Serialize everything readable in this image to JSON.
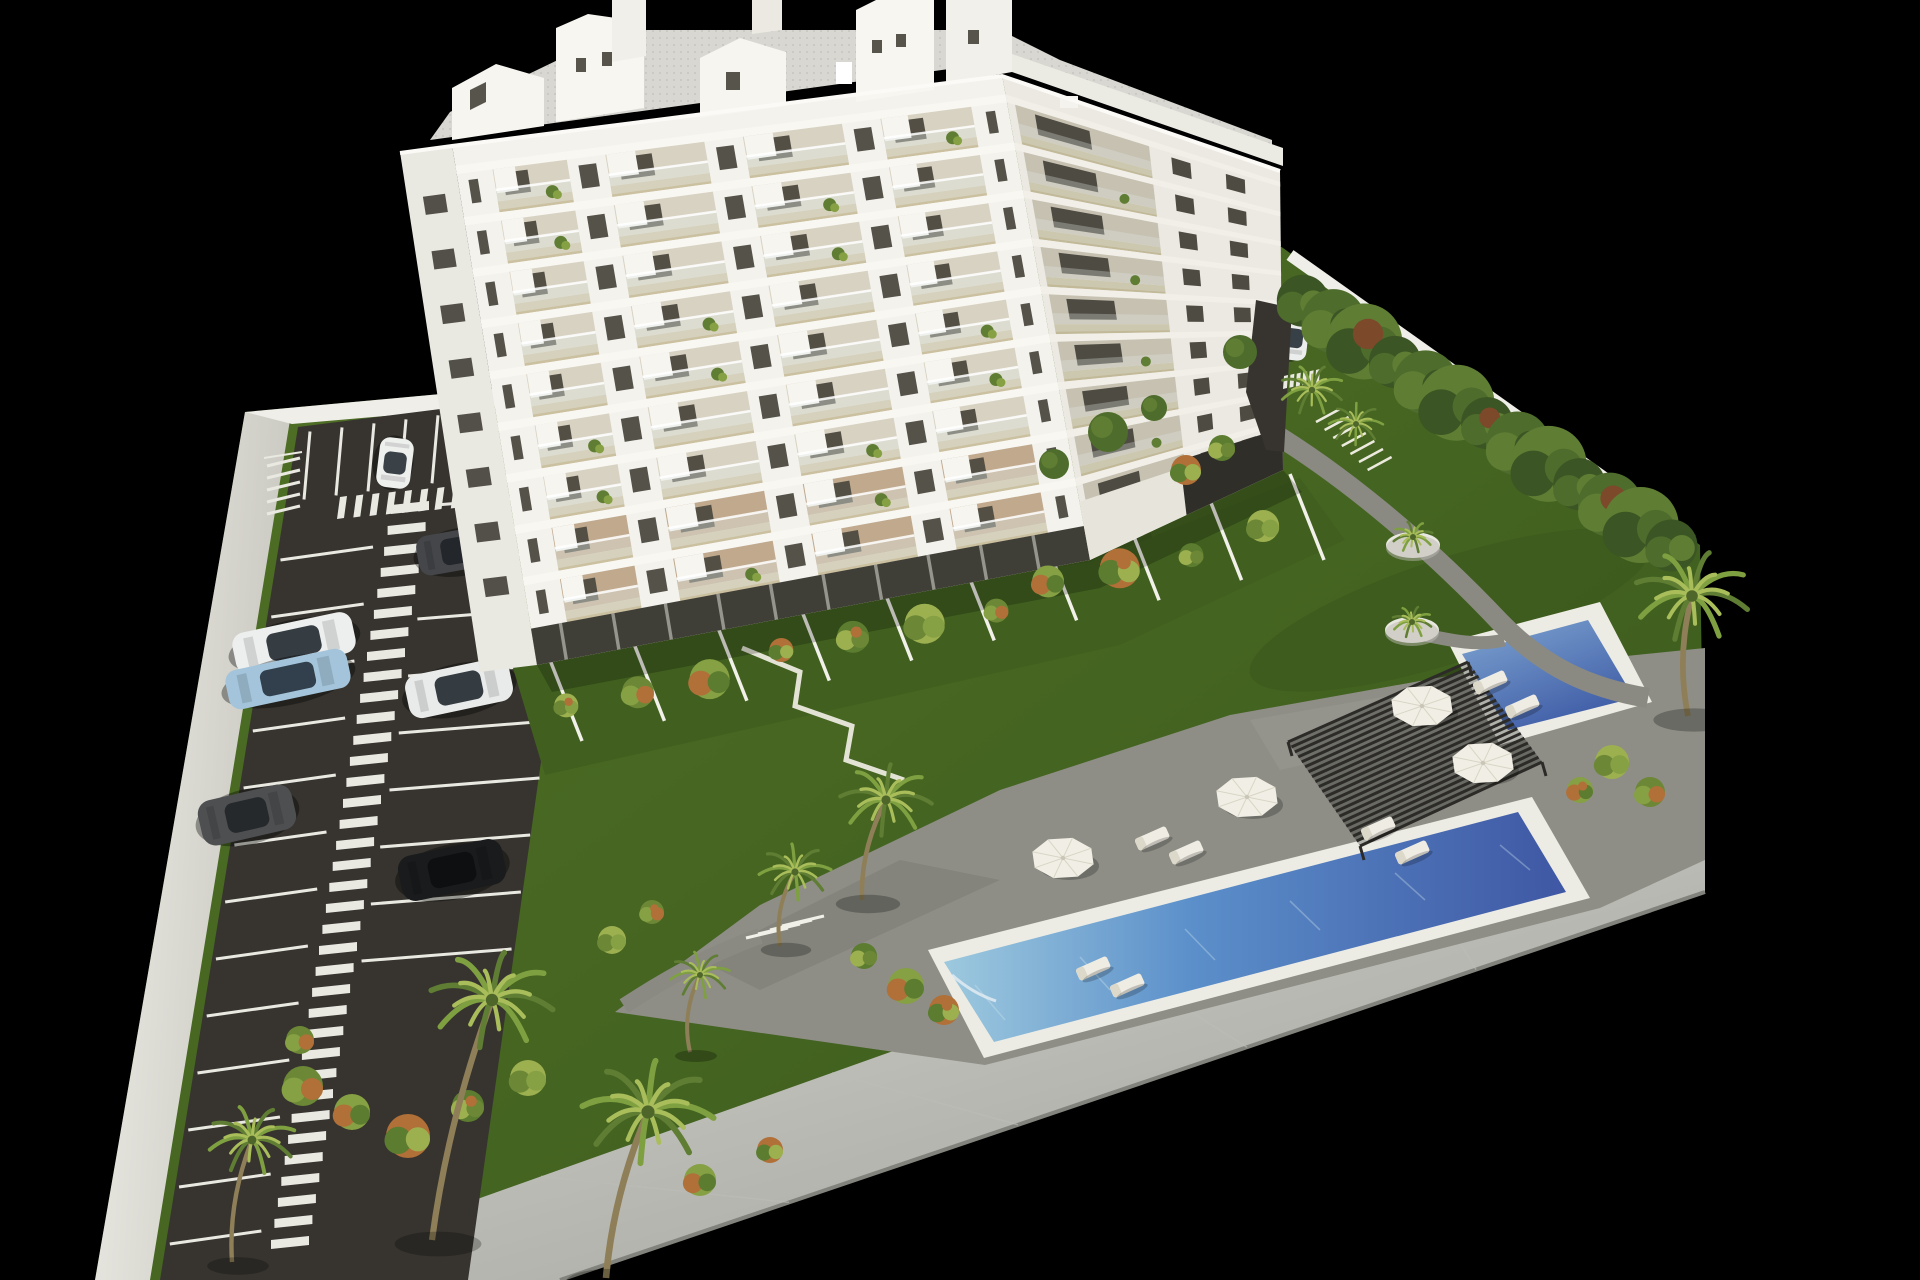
{
  "image": {
    "description": "Aerial 3D architectural rendering of a new-build residential complex on a black background: a white nine-storey apartment tower with plant-filled balconies, a surface parking lot with painted stalls and zebra walkways, landscaped lawns with palm trees and shrubs, two blue swimming pools, a slatted pergola with sun loungers and parasols, private ground-floor garden terraces and a white perimeter wall with a light walkway along the front edge."
  },
  "palette": {
    "background": "#000000",
    "wall_top": "#efeee8",
    "wall_side": "#c9c8c0",
    "walkway_light": "#dadad5",
    "walkway_dark": "#a5a59f",
    "asphalt": "#37342f",
    "marking": "#e9e8e1",
    "lawn_light": "#527326",
    "lawn_dark": "#3a591d",
    "deck": "#8e8e86",
    "path": "#8a8a82",
    "pool_rim": "#edece4",
    "pool_shallow": "#9dc9de",
    "pool_mid": "#5b8fca",
    "pool_deep": "#3f57a4",
    "pool2_light": "#7fa6d2",
    "pool2_deep": "#3f5ca6",
    "pergola": "#2c2b27",
    "umbrella": "#f1efe5",
    "lounger": "#efede3",
    "facade_front": "#f3f2ed",
    "facade_side": "#ebe9e1",
    "facade_west": "#e9e8e1",
    "slab": "#f8f7f2",
    "balcony_back": "#d8d2c2",
    "balcony_floor": "#cbc09f",
    "railing": "#e4eae8",
    "window": "#534f44",
    "storefront": "#403f37",
    "roof_terrace": "#d8d7d1",
    "roof_box": "#f6f5f0",
    "parapet": "#fbfaf6",
    "trunk": "#8f7f58",
    "palm_frond": "#7fa040",
    "palm_frond_light": "#a9bd5a",
    "hedge_dark": "#3c5524",
    "hedge_mid": "#4e6c2c",
    "hedge_light": "#5f7d33",
    "hedge_rust": "#7c492a",
    "bush_colors": [
      "#9db050",
      "#6c8836",
      "#86a044",
      "#b07038",
      "#5c7c30"
    ],
    "planter": "#e8e7e0"
  },
  "building": {
    "floor_count": 9,
    "balcony_bays_front": 4,
    "roof_penthouse_count": 5,
    "roof_chimney_count": 2,
    "balconies_have_plants": true
  },
  "parking": {
    "zebra_stripe_lane": true,
    "crosswalk_count": 2,
    "cars": [
      {
        "label": "white hatchback driving in aisle",
        "color": "#eef0ee",
        "glass": "#3a4147"
      },
      {
        "label": "dark sedan",
        "color": "#45464a",
        "glass": "#23262a"
      },
      {
        "label": "white suv",
        "color": "#edefee",
        "glass": "#353c42"
      },
      {
        "label": "light blue car",
        "color": "#a3c4da",
        "glass": "#31404c"
      },
      {
        "label": "dark gray suv",
        "color": "#4e4f51",
        "glass": "#26292c"
      },
      {
        "label": "white sedan",
        "color": "#e9ebea",
        "glass": "#343b41"
      },
      {
        "label": "black car",
        "color": "#1a1b1d",
        "glass": "#0e0f10"
      },
      {
        "label": "white car at entrance drive",
        "color": "#eceeed",
        "glass": "#384047"
      }
    ]
  },
  "pools": [
    {
      "name": "main lap pool",
      "shape": "long rectangle"
    },
    {
      "name": "secondary pool",
      "shape": "rectangle"
    }
  ],
  "amenities": {
    "pergola_count": 1,
    "umbrella_count": 4,
    "sun_lounger_count": 8,
    "planter_count": 2,
    "bike_rack_bars": 7
  },
  "vegetation": {
    "palm_count": 9,
    "hedge_cluster_count": 13,
    "private_terrace_fences": 10
  }
}
